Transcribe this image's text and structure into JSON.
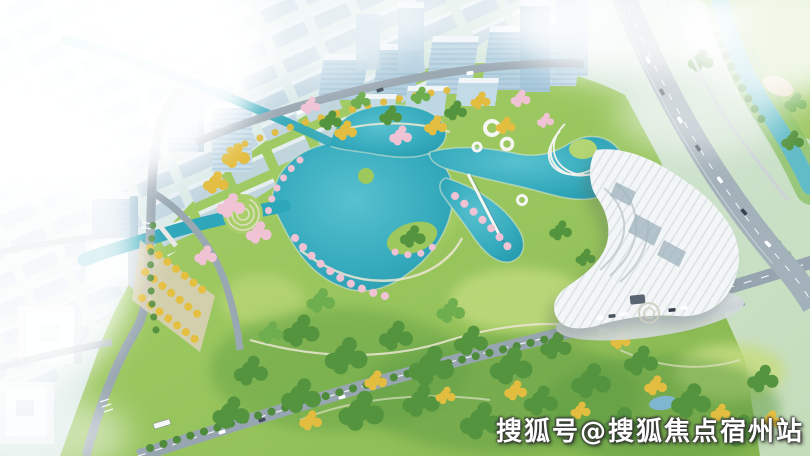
{
  "meta": {
    "type": "aerial-architectural-rendering",
    "subject": "Bird's-eye rendering of a lakeside park masterplan: central teal lake, landscaped park with autumn and blossom trees, white V-shaped exhibition building, blue-glass office district in haze, expressway and river on the right"
  },
  "watermark": {
    "text": "搜狐号@搜狐焦点宿州站"
  },
  "palette": {
    "lake": "#2fa7ba",
    "lake_light": "#58c1cf",
    "river": "#62bcc8",
    "park": "#9cc85e",
    "park_light": "#c2dc7f",
    "forest": "#55943f",
    "autumn": "#e3bd3f",
    "blossom": "#efc3d4",
    "road": "#97a5b0",
    "highway": "#a3b1ba",
    "city_haze": "#c9dbe6",
    "glass_blue": "#b7d2e2",
    "white_building": "#f3f6f7",
    "fog": "#ffffff"
  }
}
